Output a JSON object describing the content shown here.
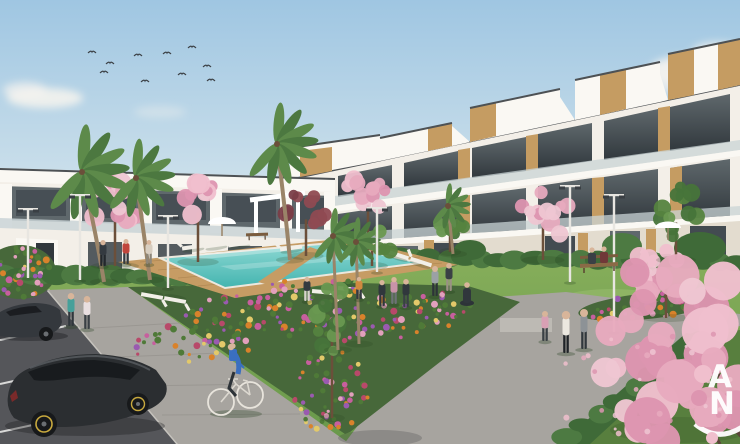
{
  "watermark": {
    "letter_top": "A",
    "letter_bottom": "N",
    "color": "#ffffff"
  },
  "palette": {
    "sky_top": "#9fc6e2",
    "sky_mid": "#c9deea",
    "sky_horizon": "#e9eef0",
    "cloud": "#f7f4ef",
    "bird": "#3c4146",
    "facade_white": "#f3efe8",
    "facade_bright": "#faf8f3",
    "facade_shade": "#e3dccf",
    "roof_trim": "#4d5154",
    "glass_dark": "#434b51",
    "glass_mid": "#5f686c",
    "glass_deep": "#31383d",
    "balustrade": "#c9d4d6",
    "wood": "#c59c62",
    "wood_line": "#96713d",
    "lawn_far": "#85ad5a",
    "lawn_near": "#68984a",
    "lawn_dark": "#587f3e",
    "lawn_patch": "#b8d68a",
    "hedge": "#3f6a38",
    "hedge_light": "#4d7a42",
    "deck": "#c69c64",
    "deck_line": "#a57e4b",
    "pool_light": "#8fd9d4",
    "pool_deep": "#43b4af",
    "pool_trim": "#ece8de",
    "path": "#a7a49f",
    "joint": "#908d88",
    "asphalt": "#55565a",
    "kerb": "#c6c3bd",
    "park_line": "#e8e8e6",
    "bed": "#47683a",
    "leaf": "#4f7a38",
    "trunk": "#6b4f3a",
    "palm_trunk": "#9a8468",
    "frond_a": "#4c7840",
    "frond_b": "#5d8a4a",
    "skin": "#d8b59a",
    "lamp": "#e8e6e1",
    "lamp_head": "#3a3f44",
    "shadow": "#26401f",
    "car_dark": "#2b2e31",
    "car_glass": "#181b1e",
    "wheel_ring": "#c8a93e",
    "white": "#ffffff",
    "branch": "#5a4438"
  },
  "scene": {
    "flower_colors": [
      "#c75f9e",
      "#d9822b",
      "#e2a0bc",
      "#9a5ab0",
      "#e3c96a",
      "#b8496a"
    ],
    "tree_palettes": {
      "pink": [
        "#e7aabe",
        "#f0bfcd",
        "#dd95b0",
        "#eec6d2"
      ],
      "red": [
        "#8f4a52",
        "#a55a60",
        "#7a3e48"
      ],
      "green": [
        "#55833f",
        "#699850",
        "#47743a"
      ]
    },
    "birds": [
      [
        92,
        52
      ],
      [
        104,
        72
      ],
      [
        110,
        63
      ],
      [
        138,
        55
      ],
      [
        145,
        81
      ],
      [
        167,
        53
      ],
      [
        182,
        74
      ],
      [
        192,
        47
      ],
      [
        207,
        66
      ],
      [
        211,
        80
      ]
    ],
    "palms": [
      {
        "cx": 82,
        "cy": 172,
        "len": 46,
        "tx": 104,
        "ty": 282,
        "lean": 14
      },
      {
        "cx": 136,
        "cy": 178,
        "len": 38,
        "tx": 150,
        "ty": 280,
        "lean": 8
      },
      {
        "cx": 277,
        "cy": 144,
        "len": 40,
        "tx": 290,
        "ty": 260,
        "lean": 8
      },
      {
        "cx": 448,
        "cy": 206,
        "len": 22,
        "tx": 453,
        "ty": 254,
        "lean": 3
      },
      {
        "cx": 333,
        "cy": 236,
        "len": 27,
        "tx": 338,
        "ty": 350,
        "lean": 3
      },
      {
        "cx": 356,
        "cy": 242,
        "len": 24,
        "tx": 359,
        "ty": 344,
        "lean": 2
      }
    ],
    "blossoms": [
      {
        "cx": 115,
        "cy": 206,
        "rx": 30,
        "ry": 26,
        "n": 13,
        "r0": 5,
        "r1": 11,
        "pal": "pink",
        "tx": 115,
        "ty": 266
      },
      {
        "cx": 198,
        "cy": 203,
        "rx": 26,
        "ry": 24,
        "n": 11,
        "r0": 5,
        "r1": 10,
        "pal": "pink",
        "tx": 198,
        "ty": 262
      },
      {
        "cx": 306,
        "cy": 211,
        "rx": 22,
        "ry": 21,
        "n": 10,
        "r0": 5,
        "r1": 9,
        "pal": "red",
        "tx": 306,
        "ty": 256
      },
      {
        "cx": 368,
        "cy": 196,
        "rx": 25,
        "ry": 23,
        "n": 11,
        "r0": 5,
        "r1": 10,
        "pal": "pink",
        "tx": 368,
        "ty": 250
      },
      {
        "cx": 543,
        "cy": 214,
        "rx": 27,
        "ry": 26,
        "n": 12,
        "r0": 5,
        "r1": 10,
        "pal": "pink",
        "tx": 543,
        "ty": 260
      },
      {
        "cx": 666,
        "cy": 270,
        "rx": 33,
        "ry": 30,
        "n": 14,
        "r0": 6,
        "r1": 12,
        "pal": "pink",
        "tx": 666,
        "ty": 318
      }
    ],
    "greens": [
      {
        "cx": 372,
        "cy": 244,
        "rx": 20,
        "ry": 17,
        "n": 9,
        "tx": 372,
        "ty": 266
      },
      {
        "cx": 676,
        "cy": 212,
        "rx": 25,
        "ry": 26,
        "n": 11,
        "tx": 676,
        "ty": 260
      },
      {
        "cx": 450,
        "cy": 230,
        "rx": 14,
        "ry": 12,
        "n": 7,
        "tx": 450,
        "ty": 252
      },
      {
        "cx": 332,
        "cy": 316,
        "rx": 16,
        "ry": 40,
        "n": 13,
        "tx": 332,
        "ty": 418
      }
    ],
    "big_blossom": {
      "cx": 688,
      "cy": 340,
      "rx": 95,
      "ry": 108,
      "n": 36,
      "r0": 10,
      "r1": 24
    },
    "petals": {
      "x0": 556,
      "x1": 740,
      "y0": 334,
      "y1": 446,
      "n": 30
    },
    "beds_dots": [
      {
        "cx": 20,
        "cy": 272,
        "rx": 34,
        "ry": 25,
        "rot": 0,
        "n": 46
      },
      {
        "cx": 245,
        "cy": 320,
        "rx": 115,
        "ry": 30,
        "rot": -16,
        "n": 115
      },
      {
        "cx": 400,
        "cy": 316,
        "rx": 85,
        "ry": 22,
        "rot": -10,
        "n": 70
      },
      {
        "cx": 332,
        "cy": 392,
        "rx": 45,
        "ry": 40,
        "rot": -70,
        "n": 55
      },
      {
        "cx": 648,
        "cy": 306,
        "rx": 66,
        "ry": 12,
        "rot": -6,
        "n": 44
      }
    ],
    "hedgerows": [
      {
        "x0": 4,
        "x1": 338,
        "y0": 274,
        "y1": 280,
        "n": 20,
        "rx": 15,
        "ry": 9
      },
      {
        "x0": 346,
        "x1": 736,
        "y0": 256,
        "y1": 263,
        "n": 24,
        "rx": 13,
        "ry": 8
      },
      {
        "x0": 568,
        "x1": 700,
        "y0": 438,
        "y1": 338,
        "n": 9,
        "rx": 13,
        "ry": 8
      }
    ],
    "lamps": [
      {
        "x": 28,
        "yh": 210,
        "yb": 278
      },
      {
        "x": 80,
        "yh": 196,
        "yb": 280
      },
      {
        "x": 168,
        "yh": 217,
        "yb": 288
      },
      {
        "x": 377,
        "yh": 209,
        "yb": 272
      },
      {
        "x": 570,
        "yh": 187,
        "yb": 282
      },
      {
        "x": 614,
        "yh": 196,
        "yb": 332
      }
    ],
    "loungers": [
      {
        "x": 193,
        "y": 247,
        "a": -8
      },
      {
        "x": 216,
        "y": 245,
        "a": -8
      },
      {
        "x": 239,
        "y": 244,
        "a": -8
      },
      {
        "x": 291,
        "y": 248,
        "a": -8
      },
      {
        "x": 398,
        "y": 255,
        "a": 18
      },
      {
        "x": 421,
        "y": 262,
        "a": 18
      },
      {
        "x": 323,
        "y": 292,
        "a": 185
      },
      {
        "x": 349,
        "y": 289,
        "a": 185
      },
      {
        "x": 152,
        "y": 296,
        "a": 190
      },
      {
        "x": 175,
        "y": 300,
        "a": 190
      }
    ],
    "people": [
      {
        "x": 71,
        "y": 326,
        "h": 33,
        "s": "#46a09a",
        "p": "#30373c"
      },
      {
        "x": 87,
        "y": 329,
        "h": 33,
        "s": "#e9dfe0",
        "p": "#3a4045"
      },
      {
        "x": 103,
        "y": 266,
        "h": 26,
        "s": "#343a40",
        "p": "#23282c"
      },
      {
        "x": 126,
        "y": 264,
        "h": 25,
        "s": "#c0453c",
        "p": "#343a40"
      },
      {
        "x": 149,
        "y": 264,
        "h": 24,
        "s": "#d8cec0",
        "p": "#8d8679"
      },
      {
        "x": 307,
        "y": 301,
        "h": 24,
        "s": "#343a40",
        "p": "#d8d4cc"
      },
      {
        "x": 359,
        "y": 299,
        "h": 22,
        "s": "#d0893f",
        "p": "#343a40"
      },
      {
        "x": 382,
        "y": 306,
        "h": 26,
        "s": "#30373c",
        "p": "#30373c"
      },
      {
        "x": 394,
        "y": 304,
        "h": 27,
        "s": "#c893a8",
        "p": "#6d7277"
      },
      {
        "x": 406,
        "y": 307,
        "h": 28,
        "s": "#30373c",
        "p": "#3a4045"
      },
      {
        "x": 435,
        "y": 296,
        "h": 30,
        "s": "#9ba1a5",
        "p": "#2d3338"
      },
      {
        "x": 449,
        "y": 291,
        "h": 28,
        "s": "#3a4045",
        "p": "#9a9184"
      },
      {
        "x": 545,
        "y": 341,
        "h": 30,
        "s": "#d8a0b4",
        "p": "#3a4045"
      },
      {
        "x": 566,
        "y": 353,
        "h": 42,
        "s": "#ece8e0",
        "p": "#1f2327"
      },
      {
        "x": 584,
        "y": 349,
        "h": 40,
        "s": "#8d9296",
        "p": "#30373c"
      }
    ],
    "parasols": [
      {
        "x": 222,
        "y": 224
      },
      {
        "x": 668,
        "y": 228
      }
    ]
  }
}
